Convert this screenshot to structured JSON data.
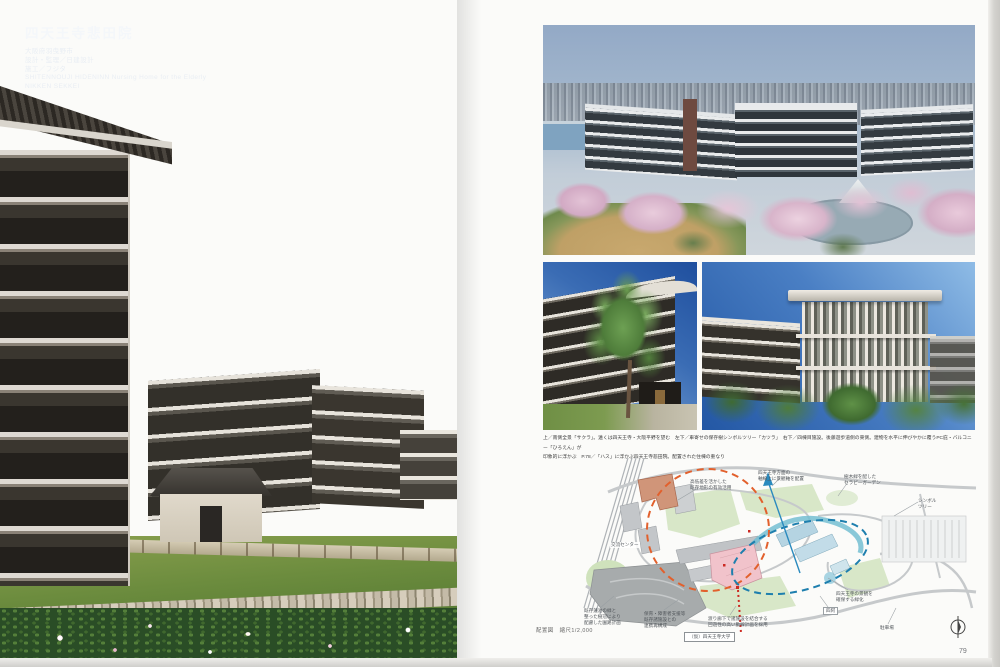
{
  "spread": {
    "left_page": {
      "title": "四天王寺悲田院",
      "subtitle_location": "大阪府羽曳野市",
      "credit_design": "設計・監理／日建設計",
      "credit_builder": "施工／フジタ",
      "title_en": "SHITENNOUJI HIDENINN Nursing Home for the Elderly",
      "credit_en": "NIKKEN SEKKEI"
    },
    "right_page": {
      "caption_line1": "上／南側全景「サクラ」。遠くは四天王寺・大阪平野を望む　左下／車寄せの保存樹シンボルツリー「カツラ」　右下／四棟目施設。後藤遊歩道側の東側。建物を水平に伸びやかに覆うPC庇・バルコニー「ひろえん」が",
      "caption_line2": "印象的に浮かぶ　P.78／「ハス」に浮かぶ四天王寺悲田院。配置された住棟の重なり",
      "site_plan": {
        "scale_label": "配置図　縮尺1/2,000",
        "university_label": "（仮）四天王寺大学",
        "annotations": {
          "a1": "高低差を活かした\n既存地形の有効活用",
          "a2": "四天王寺方面の\n軸線上に景観軸を配置",
          "a3": "樹木緑を配した\nセラピーガーデン",
          "a4": "シンボル\nツリー",
          "a5": "交流センター",
          "a6": "既存蓮池の緑と\n整った樹冠により\n配慮した園路計画",
          "a7": "保育・障害者支援等\n既存諸施設との\n連携再構成",
          "a8": "渡り廊下で諸施設を結合する\n回遊性の高い動線計画を採用",
          "a9": "四阿",
          "a10": "四天王寺の景観を\n確保する緑化",
          "a11": "駐車場"
        },
        "accent_colors": {
          "zone_circle_dash": "#e2602c",
          "walk_loop_dash": "#1e7fae",
          "path_dots": "#cc2a22",
          "new_building_fill": "#f1c3cb",
          "existing_building_fill": "#d09579",
          "water_fill": "#74bed2"
        },
        "icons": {
          "north_arrow": "north-arrow"
        }
      },
      "page_number": "79"
    }
  }
}
